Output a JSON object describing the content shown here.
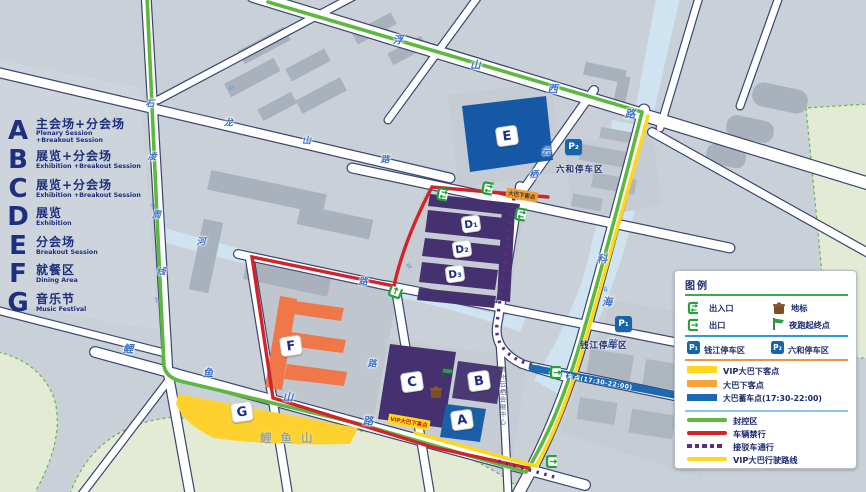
{
  "left_legend": {
    "items": [
      {
        "letter": "A",
        "zh": "主会场+分会场",
        "en": "Plenary Session\n+Breakout Session"
      },
      {
        "letter": "B",
        "zh": "展览+分会场",
        "en": "Exhibition +Breakout Session"
      },
      {
        "letter": "C",
        "zh": "展览+分会场",
        "en": "Exhibition +Breakout Session"
      },
      {
        "letter": "D",
        "zh": "展览",
        "en": "Exhibition"
      },
      {
        "letter": "E",
        "zh": "分会场",
        "en": "Breakout Session"
      },
      {
        "letter": "F",
        "zh": "就餐区",
        "en": "Dining Area"
      },
      {
        "letter": "G",
        "zh": "音乐节",
        "en": "Music Festival"
      }
    ]
  },
  "map": {
    "roads": {
      "fushanxi": "浮山西路",
      "shilongshan": "石龙山路",
      "lingzhou": "凌周线",
      "yunqi": "云栖路",
      "kehai": "科海路",
      "liyushan": "鲤鱼山路",
      "he": "河",
      "lu1": "路",
      "lu2": "路"
    },
    "areas": {
      "hill": "鲤鱼山",
      "venue": "杭州云栖会展中心"
    },
    "buildings": {
      "a": "A",
      "b": "B",
      "c": "C",
      "d1": "D₁",
      "d2": "D₂",
      "d3": "D₃",
      "e": "E",
      "f": "F",
      "g": "G"
    },
    "parking": {
      "p1": "P₁",
      "p1_label": "钱江停车区",
      "p2": "P₂",
      "p2_label": "六和停车区"
    },
    "badges": {
      "bus_drop": "大巴下客点",
      "vip_drop": "VIP大巴下客点",
      "bus_stage": "大巴蓄车点(17:30-22:00)"
    },
    "icons": {
      "two_way": "⇄"
    }
  },
  "legend": {
    "title": "图例",
    "entrance": "出入口",
    "landmark": "地标",
    "exit": "出口",
    "night_run": "夜跑起终点",
    "p1": "P₁",
    "p1_label": "钱江停车区",
    "p2": "P₂",
    "p2_label": "六和停车区",
    "vip_drop": "VIP大巴下客点",
    "bus_drop": "大巴下客点",
    "bus_stage": "大巴蓄车点(17:30-22:00)",
    "closed": "封控区",
    "no_vehicle": "车辆禁行",
    "shuttle": "接驳车通行",
    "vip_route": "VIP大巴行驶路线"
  },
  "colors": {
    "closed_green": "#5cb83f",
    "no_vehicle_red": "#d2232a",
    "shuttle_purple": "#5b2e84",
    "vip_yellow": "#ffd71c",
    "bus_stage_blue": "#1a6ab3",
    "bus_drop_orange": "#f39c2d",
    "building_blue": "#1b5fa8",
    "building_purple": "#463170",
    "dining_orange": "#ef7748",
    "parking_blue": "#1565ad"
  }
}
